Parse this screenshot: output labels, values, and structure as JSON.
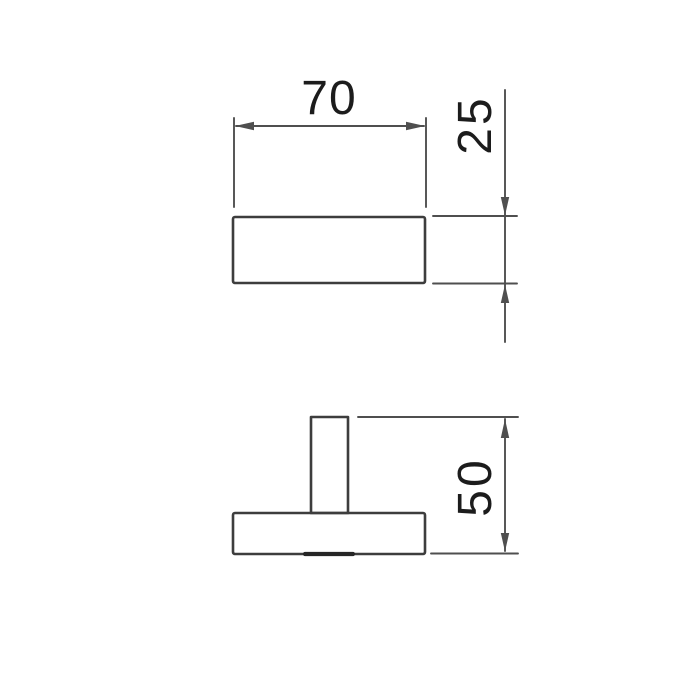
{
  "drawing": {
    "dimensions": {
      "front_width": {
        "label": "70",
        "orientation": "horizontal",
        "applies_to": "front-view width"
      },
      "front_height": {
        "label": "25",
        "orientation": "vertical",
        "applies_to": "front-view height"
      },
      "side_height": {
        "label": "50",
        "orientation": "vertical",
        "applies_to": "side-view overall height"
      }
    },
    "colors": {
      "background": "#ffffff",
      "outline": "#3d3d3d",
      "dimension_line": "#4f4f4f",
      "label_text": "#1c1c1c",
      "thick_edge": "#262626"
    }
  }
}
